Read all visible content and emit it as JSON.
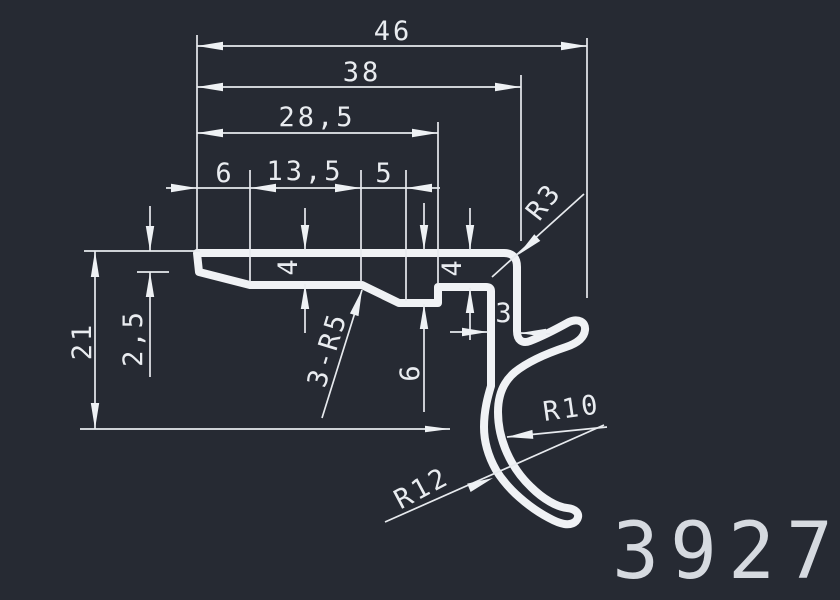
{
  "drawing": {
    "type": "cad-profile-section",
    "part_number": "3927",
    "colors": {
      "background": "#262a33",
      "line": "#f0f2f5",
      "text": "#e9ecf0"
    },
    "dimensions": {
      "overall_width": "46",
      "width_to_leg": "38",
      "width_to_notch": "28,5",
      "segment_left": "6",
      "segment_middle": "13,5",
      "segment_right": "5",
      "corner_radius": "R3",
      "flange_thickness_left": "4",
      "flange_thickness_right": "4",
      "edge_thickness": "2,5",
      "overall_height": "21",
      "fillet_note": "3-R5",
      "notch_depth": "6",
      "leg_thickness": "3",
      "hook_inner_radius": "R10",
      "hook_outer_radius": "R12"
    }
  }
}
